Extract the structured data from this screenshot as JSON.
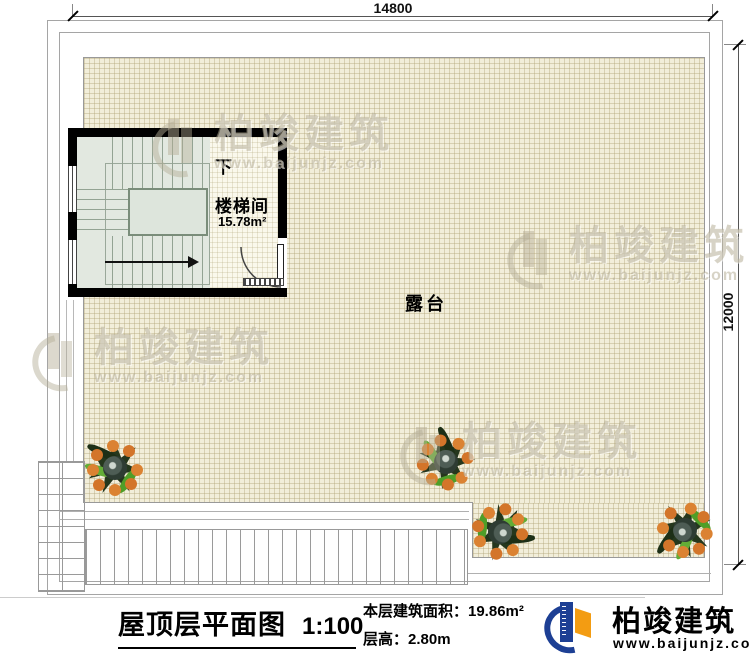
{
  "plan": {
    "dimensions": {
      "top_width": "14800",
      "right_height": "12000"
    },
    "stairwell": {
      "name": "楼梯间",
      "area": "15.78m²",
      "direction_label": "下"
    },
    "terrace": {
      "label": "露台"
    }
  },
  "title_block": {
    "title": "屋顶层平面图",
    "scale": "1:100",
    "area_text": "本层建筑面积：19.86m²",
    "floor_height_text": "层高：2.80m"
  },
  "brand": {
    "name": "柏竣建筑",
    "website": "www.baijunjz.com"
  },
  "watermark": {
    "name": "柏竣建筑",
    "website": "www.baijunjz.com"
  },
  "colors": {
    "terrace_fill": "#f2eeda",
    "grid_line": "#cfc5a4",
    "wall": "#000000",
    "stair_fill": "#e2e8e0",
    "brand_blue": "#1d3f94",
    "brand_orange": "#f39c12",
    "fruit_orange": "#d97f2e",
    "leaf_green": "#55a12c",
    "watermark_gray": "#b2ab92"
  }
}
